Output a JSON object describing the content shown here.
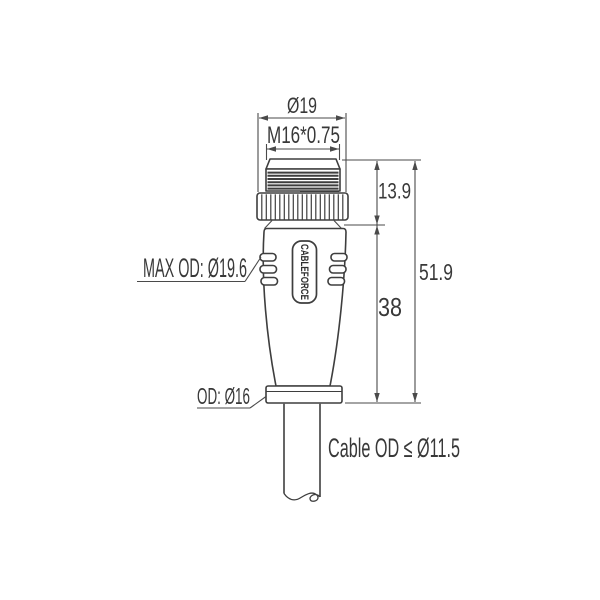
{
  "brand": "CABLEFORCE",
  "labels": {
    "top_diameter": "Ø19",
    "thread_spec": "M16*0.75",
    "coupling_nut_height": "13.9",
    "body_height": "38",
    "total_length": "51.9",
    "max_od": "MAX OD: Ø19.6",
    "collar_od": "OD: Ø16",
    "cable_od": "Cable OD ≤ Ø11.5"
  },
  "colors": {
    "line": "#3e3e3e",
    "dimension": "#4a4a4a",
    "text": "#383838",
    "background": "#ffffff"
  }
}
